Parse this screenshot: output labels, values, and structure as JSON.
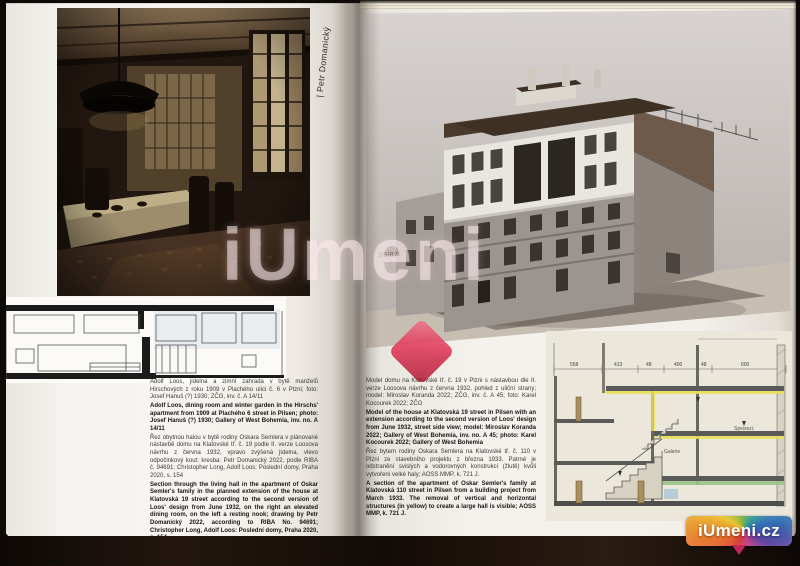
{
  "book": {
    "author_vertical": "| Petr Domanický",
    "page_number": "86|87"
  },
  "left_captions": {
    "cs1": "Adolf Loos, jídelna a zimní zahrada v bytě manželů Hirschových z roku 1909 v Plachého ulici č. 6 v Plzni; foto: Josef Hanuš (?) 1930; ZČG, inv. č. A 14/11",
    "en1": "Adolf Loos, dining room and winter garden in the Hirschs' apartment from 1909 at Plachého 6 street in Pilsen; photo: Josef Hanuš (?) 1930; Gallery of West Bohemia, inv. no. A 14/11",
    "cs2": "Řez obytnou halou v bytě rodiny Oskara Semlera v plánované nástavbě domu na Klatovské tř. č. 19 podle II. verze Loosova návrhu z června 1932, vpravo zvýšená jídelna, vlevo odpočinkový kout; kresba: Petr Domanický 2022, podle RIBA č. 94691; Christopher Long, Adolf Loos: Poslední domy, Praha 2020, s. 154",
    "en2": "Section through the living hall in the apartment of Oskar Semler's family in the planned extension of the house at Klatovská 19 street according to the second version of Loos' design from June 1932, on the right an elevated dining room, on the left a resting nook; drawing by Petr Domanický 2022, according to RIBA No. 94691; Christopher Long, Adolf Loos: Poslední domy, Praha 2020, p. 154"
  },
  "right_captions": {
    "cs1": "Model domu na Klatovské tř. č. 19 v Plzni s nástavbou dle II. verze Loosova návrhu z června 1932, pohled z uliční strany; model: Miroslav Koranda 2022; ZČG, inv. č. A 45; foto: Karel Kocourek 2022; ZČG",
    "en1": "Model of the house at Klatovská 19 street in Pilsen with an extension according to the second version of Loos' design from June 1932, street side view; model: Miroslav Koranda 2022; Gallery of West Bohemia, inv. no. A 45; photo: Karel Kocourek 2022; Gallery of West Bohemia",
    "cs2": "Řez bytem rodiny Oskara Semlera na Klatovské tř. č. 110 v Plzni ze stavebního projektu z března 1933. Patrné je odstranění svislých a vodorovných konstrukcí (žlutě) kvůli vytvoření velké haly; AOSS MMP, k. 721 J.",
    "en2": "A section of the apartment of Oskar Semler's family at Klatovská 110 street in Pilsen from a building project from March 1933. The removal of vertical and horizontal structures (in yellow) to create a large hall is visible; AOSS MMP, k. 721 J."
  },
  "section_drawing": {
    "dims": [
      "558",
      "413",
      "48",
      "400",
      "48",
      "600"
    ],
    "label_galerie": "Galerie",
    "label_speise": "Speisezi."
  },
  "watermark": {
    "text": "iUmeni",
    "logo_text": "iUmeni.cz"
  },
  "colors": {
    "accent_red": "#d01638",
    "highlight_yellow": "#e8e05a",
    "paper": "#f4f1ec"
  }
}
